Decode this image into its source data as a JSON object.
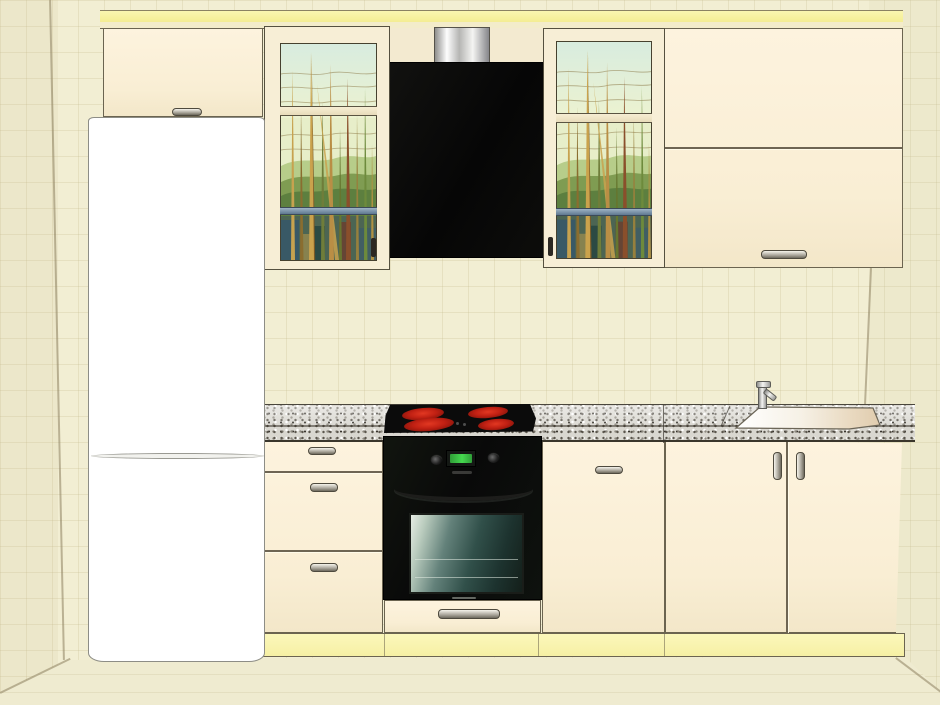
{
  "title": "Kitchen interior 3D render",
  "room": {
    "wall_color": "#f2eed3",
    "floor_color": "#efebd0",
    "tile_grid_color": "#e2dcba",
    "left_wall_corner": "visible",
    "right_wall_corner": "visible"
  },
  "kitchen": {
    "cabinet_front_color": "#fbf0d8",
    "cornice_color": "#f7f2a3",
    "plinth_color": "#faf6b2",
    "countertop": {
      "material_label": "grey speckled granite worktop",
      "base_color": "#d9d7d0"
    },
    "upper_row": {
      "over_fridge_cabinet": {
        "label": "wall cabinet with lift-up door above refrigerator",
        "handle_count": 1
      },
      "glass_cabinet_left": {
        "label": "glass-door wall cabinet with green reed artwork"
      },
      "hood": {
        "label": "black cooker hood with stainless chimney duct",
        "body_color": "#0b0b0b"
      },
      "glass_cabinet_right": {
        "label": "glass-door wall cabinet with green reed artwork"
      },
      "double_flap_cabinet": {
        "label": "wide wall cabinet with two horizontal flap doors",
        "handle_count": 1
      }
    },
    "base_row": {
      "drawer_unit": {
        "label": "base unit with three drawers",
        "drawer_count": 3
      },
      "oven_housing": {
        "label": "oven housing column with drawer below"
      },
      "door_cabinet": {
        "label": "base cabinet with single door",
        "handle_count": 1
      },
      "sink_cabinet": {
        "label": "sink base cabinet with two doors",
        "door_count": 2
      }
    },
    "appliances": {
      "refrigerator": {
        "label": "white two-door refrigerator",
        "color": "#ffffff",
        "door_count": 2
      },
      "oven": {
        "label": "black built-in electric oven",
        "display_color": "#45d84f",
        "knob_count": 2
      },
      "cooktop": {
        "label": "black ceramic cooktop with four glowing burners",
        "burner_count": 4,
        "burner_color": "#c92417"
      },
      "sink": {
        "label": "inset flat sink with single-lever chrome faucet"
      }
    },
    "artwork": {
      "glass_art": {
        "label": "stained-glass style reeds and grass landscape",
        "sky_color": "#d8ecdf",
        "green_color": "#7f9c52"
      }
    }
  }
}
